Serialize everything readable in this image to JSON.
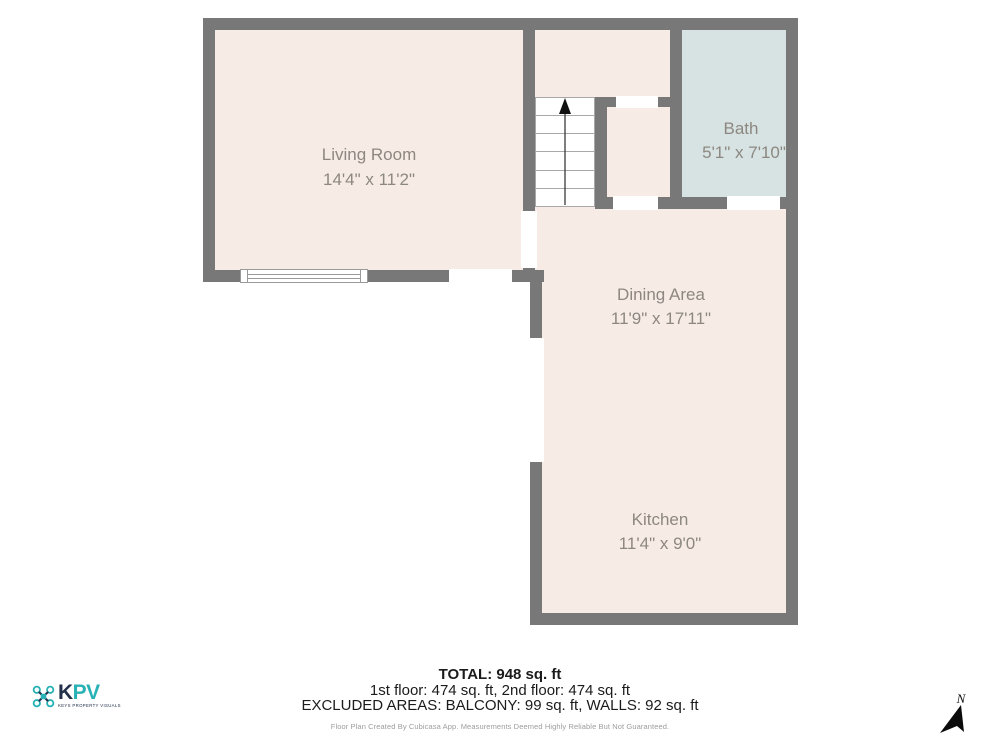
{
  "plan": {
    "rooms": [
      {
        "name": "Living Room",
        "dims": "14'4\" x 11'2\""
      },
      {
        "name": "Bath",
        "dims": "5'1\" x 7'10\""
      },
      {
        "name": "Dining Area",
        "dims": "11'9\" x 17'11\""
      },
      {
        "name": "Kitchen",
        "dims": "11'4\" x 9'0\""
      }
    ]
  },
  "summary": {
    "total": "TOTAL: 948 sq. ft",
    "floors": "1st floor: 474 sq. ft, 2nd floor: 474 sq. ft",
    "excluded": "EXCLUDED AREAS: BALCONY: 99 sq. ft, WALLS: 92 sq. ft",
    "disclaimer": "Floor Plan Created By Cubicasa App. Measurements Deemed Highly Reliable But Not Guaranteed."
  },
  "logo": {
    "brand_k": "K",
    "brand_pv": "PV",
    "tagline": "KEYS PROPERTY VISUALS"
  },
  "compass": {
    "label": "N"
  },
  "colors": {
    "wall": "#787878",
    "floor": "#f6ece5",
    "bath_floor": "#d6e3e2",
    "room_label": "#8d8781",
    "brand_teal": "#29b2b5",
    "brand_navy": "#22304a"
  }
}
